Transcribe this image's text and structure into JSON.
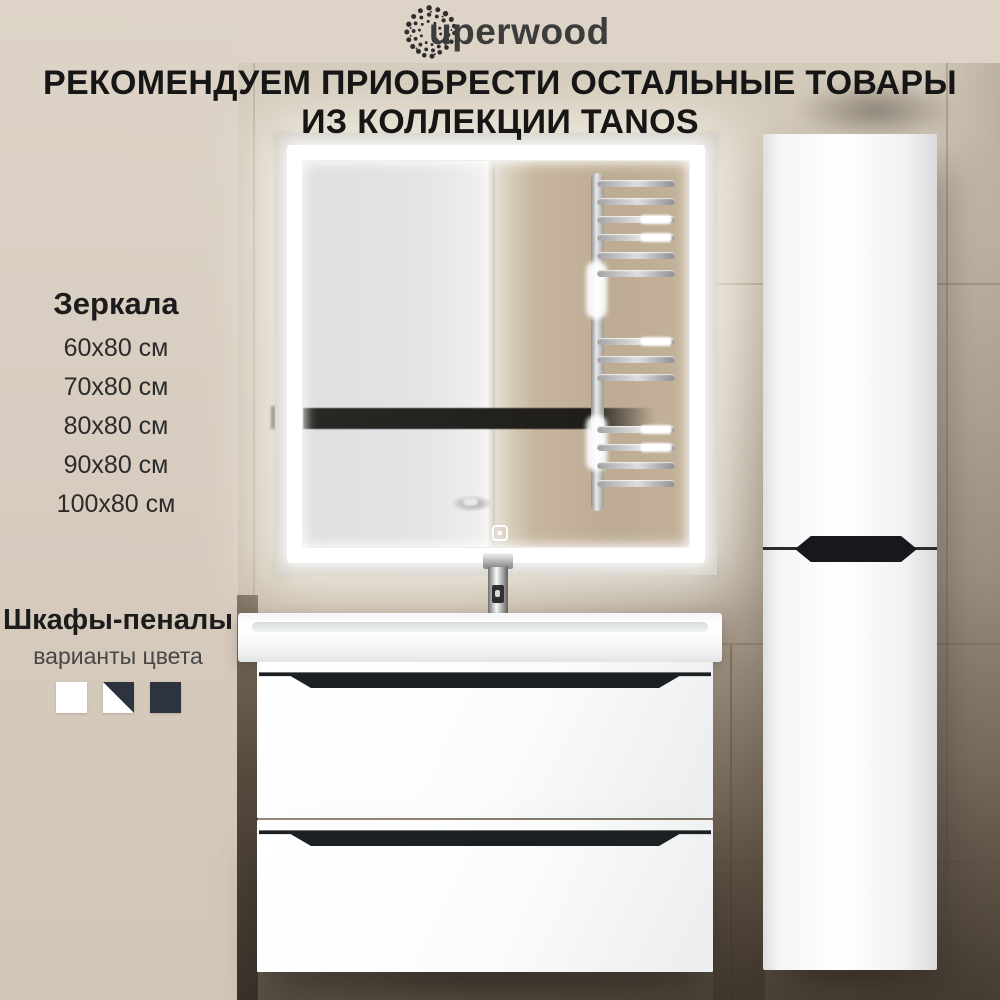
{
  "brand": {
    "logo_text": "uperwood"
  },
  "heading": {
    "line1": "РЕКОМЕНДУЕМ ПРИОБРЕСТИ ОСТАЛЬНЫЕ ТОВАРЫ",
    "line2": "ИЗ КОЛЛЕКЦИИ TANOS"
  },
  "mirrors": {
    "title": "Зеркала",
    "sizes": [
      "60х80 см",
      "70х80 см",
      "80х80 см",
      "90х80 см",
      "100х80 см"
    ]
  },
  "pencil_cabinets": {
    "title": "Шкафы-пеналы",
    "subtitle": "варианты цвета",
    "swatches": [
      {
        "name": "white",
        "color": "#ffffff"
      },
      {
        "name": "white-dark-combo",
        "color_top_right": "#2d3440",
        "color_bottom_left": "#ffffff"
      },
      {
        "name": "dark",
        "color": "#2d3440"
      }
    ]
  },
  "colors": {
    "text_primary": "#161616",
    "logo_text": "#3c3c3c",
    "background_beige": "#d8cec1",
    "furniture_white": "#fbfcfc",
    "handle_black": "#1d2023",
    "swatch_dark": "#2d3440"
  }
}
